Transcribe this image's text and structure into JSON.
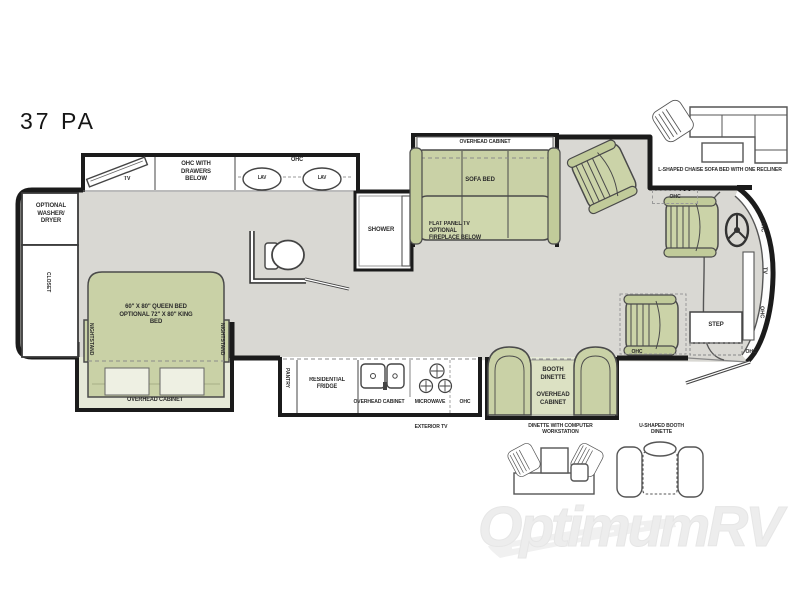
{
  "title": "37 PA",
  "watermark": "OptimumRV",
  "colors": {
    "floor": "#d9d8d3",
    "furniture_green": "#c9d1a6",
    "furniture_green_light": "#e6e9d8",
    "wall": "#1b1b1b",
    "label_text": "#2b2b2b",
    "watermark_gray": "#ededed"
  },
  "labels": {
    "optional_washer_dryer": "OPTIONAL WASHER/ DRYER",
    "closet": "CLOSET",
    "tv": "TV",
    "ohc_with_drawers": "OHC WITH DRAWERS BELOW",
    "ohc": "OHC",
    "lav": "LAV",
    "queen_bed": "60\" X 80\" QUEEN BED OPTIONAL 72\" X 80\" KING BED",
    "nightstand": "NIGHTSTAND",
    "overhead_cabinet": "OVERHEAD CABINET",
    "shower": "SHOWER",
    "flat_panel_tv": "FLAT PANEL TV OPTIONAL FIREPLACE BELOW",
    "sofa_bed": "SOFA BED",
    "l_shaped_sofa": "L-SHAPED CHAISE SOFA BED WITH ONE RECLINER",
    "step": "STEP",
    "pantry": "PANTRY",
    "residential_fridge": "RESIDENTIAL FRIDGE",
    "microwave": "MICROWAVE",
    "exterior_tv": "EXTERIOR TV",
    "booth_dinette": "BOOTH DINETTE",
    "dinette_computer": "DINETTE WITH COMPUTER WORKSTATION",
    "u_shaped_booth": "U-SHAPED BOOTH DINETTE"
  }
}
